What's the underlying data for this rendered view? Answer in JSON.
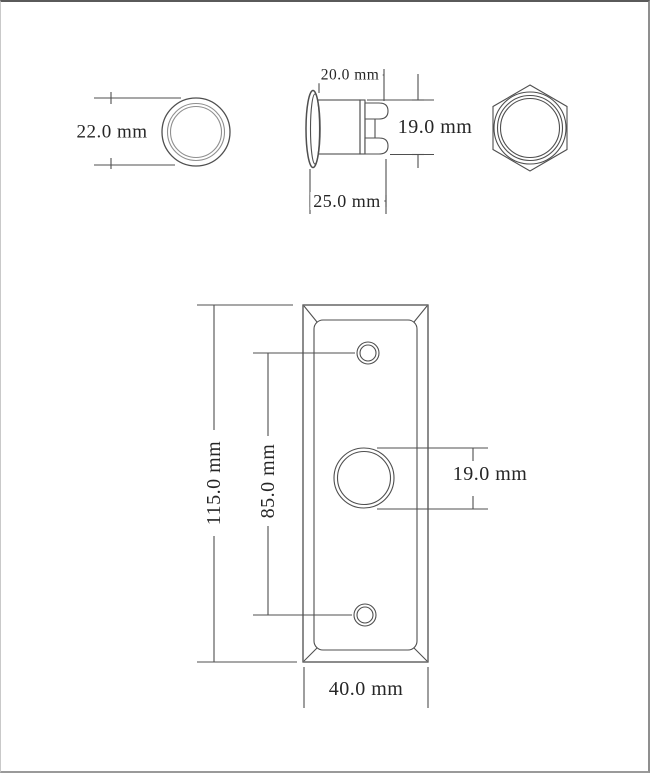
{
  "drawing": {
    "title": "push-button dimension drawing",
    "views": {
      "front": {
        "name": "front view",
        "diameter_label": "22.0 mm"
      },
      "side": {
        "name": "side view",
        "bezel_depth_label": "20.0 mm",
        "total_length_label": "25.0 mm",
        "body_diameter_label": "19.0 mm"
      },
      "nut": {
        "name": "hex nut rear view"
      },
      "plate": {
        "name": "mounting plate view",
        "height_label": "115.0 mm",
        "hole_spacing_label": "85.0 mm",
        "button_hole_label": "19.0 mm",
        "width_label": "40.0 mm"
      }
    },
    "colors": {
      "line": "#4f4f4f",
      "ring_gray": "#8f8f8f",
      "text": "#262626",
      "background": "#ffffff",
      "border_top": "#5a5a5a",
      "border_bottom": "#9a9a9a"
    }
  }
}
